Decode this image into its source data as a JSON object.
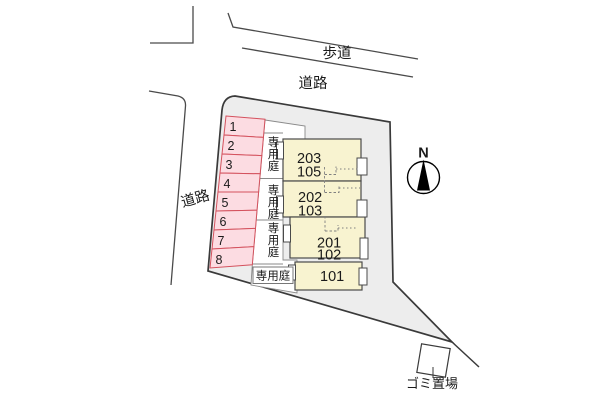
{
  "diagram": {
    "roads": {
      "sidewalk_label": "歩道",
      "top_road_label": "道路",
      "left_road_label": "道路"
    },
    "parking": {
      "space_numbers": [
        "1",
        "2",
        "3",
        "4",
        "5",
        "6",
        "7",
        "8"
      ]
    },
    "gardens": {
      "garden_labels": [
        "専用庭",
        "専用庭",
        "専用庭"
      ],
      "ground_floor_garden_label": "専用庭"
    },
    "building": {
      "units": [
        {
          "upper": "203",
          "lower": "105"
        },
        {
          "upper": "202",
          "lower": "103"
        },
        {
          "upper": "201",
          "lower": "102"
        },
        {
          "upper": "101",
          "lower": ""
        }
      ]
    },
    "compass": {
      "north_label": "N"
    },
    "waste": {
      "label": "ゴミ置場"
    },
    "colors": {
      "parking_fill": "#fcdce2",
      "parking_border": "#d4525e",
      "building_fill": "#f8f3d0",
      "site_fill": "#ededed",
      "outline": "#3a3a3a"
    }
  }
}
